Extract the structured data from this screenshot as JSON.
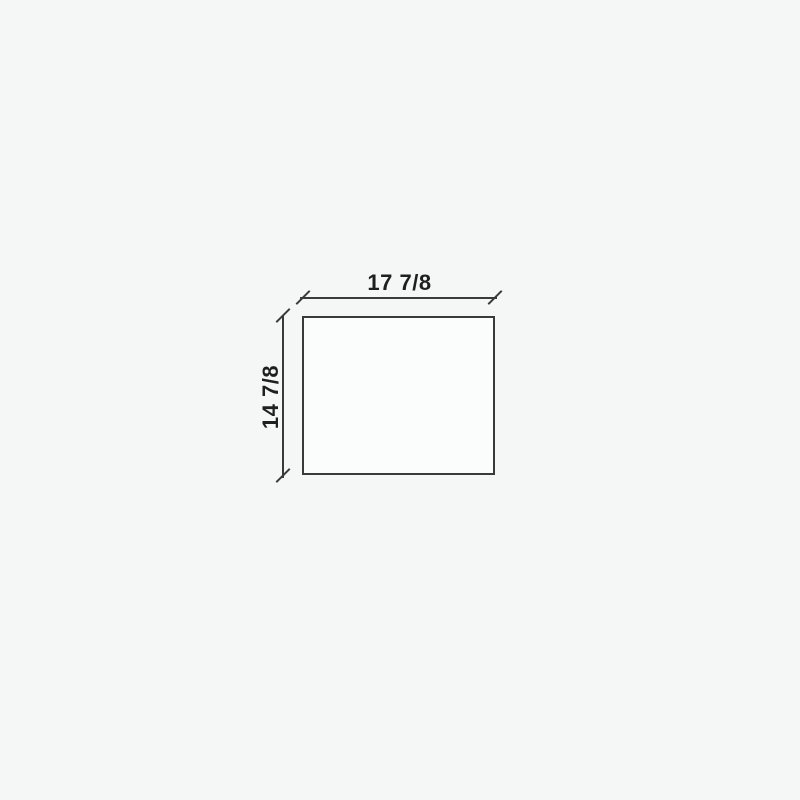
{
  "drawing": {
    "type": "technical-dimension-drawing",
    "shape": "rectangle",
    "dimensions": {
      "width_label": "17 7/8",
      "height_label": "14 7/8"
    },
    "colors": {
      "background": "#f5f6f6",
      "line": "#3a3a3a",
      "shape_fill": "#fbfcfc",
      "text": "#1f1f1f"
    }
  }
}
